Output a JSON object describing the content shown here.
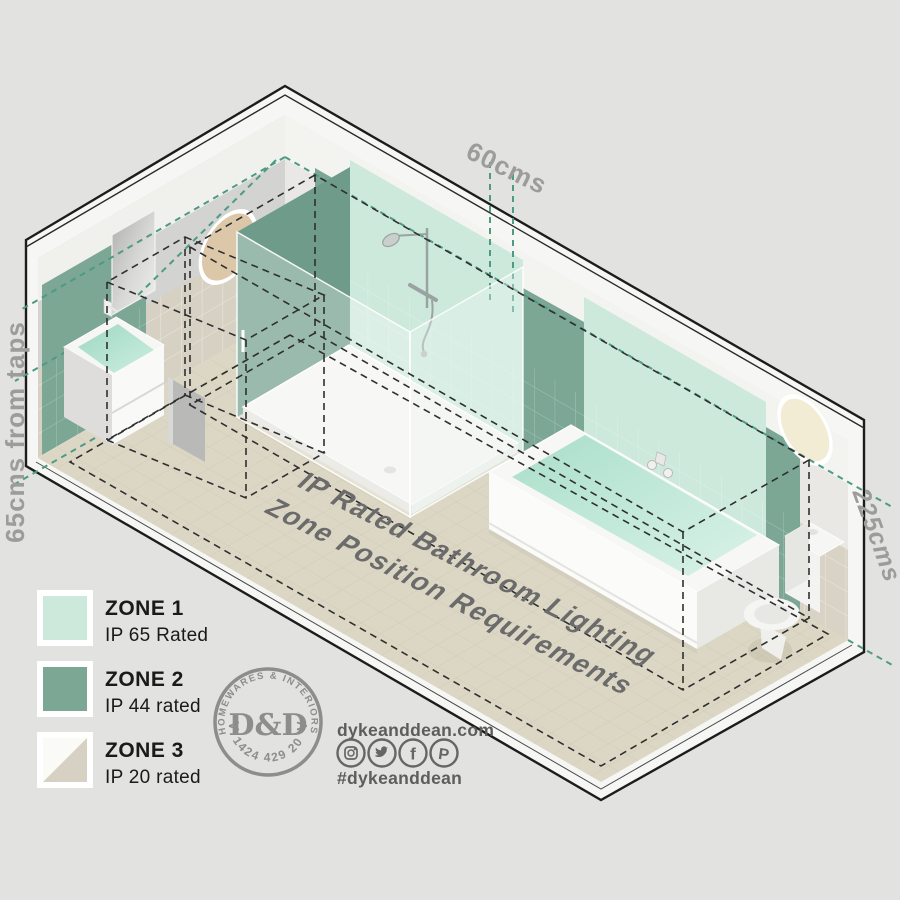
{
  "colors": {
    "background": "#e2e2e1",
    "zone1": "#cde9dc",
    "zone1_bright": "#d6f0e4",
    "zone2": "#7ca795",
    "zone2_dark": "#6f9c8a",
    "zone3_light": "#fafaf7",
    "zone3_dark": "#d6d1c2",
    "teal_dash": "#4d9a86",
    "black_dash": "#2f2f2f",
    "measurement_text": "#9c9c9c",
    "title_text": "#6b6b6b",
    "logo_gray": "#8d8d8d",
    "footer_text": "#5d5d5d"
  },
  "measurements": {
    "top": "60cms",
    "left": "65cms from taps",
    "right": "225cms"
  },
  "title": {
    "line1": "IP Rated Bathroom Lighting",
    "line2": "Zone Position Requirements"
  },
  "legend": {
    "items": [
      {
        "zone": "ZONE 1",
        "rating": "IP 65 Rated"
      },
      {
        "zone": "ZONE 2",
        "rating": "IP 44 rated"
      },
      {
        "zone": "ZONE 3",
        "rating": "IP 20 rated"
      }
    ]
  },
  "logo": {
    "arc_top": "HOMEWARES & INTERIORS",
    "monogram": "D&D",
    "arrow_left": "<",
    "arrow_right": ">",
    "phone": "01424 429 202"
  },
  "footer": {
    "website": "dykeanddean.com",
    "hashtag": "#dykeanddean",
    "facebook_glyph": "f",
    "pinterest_glyph": "P"
  }
}
